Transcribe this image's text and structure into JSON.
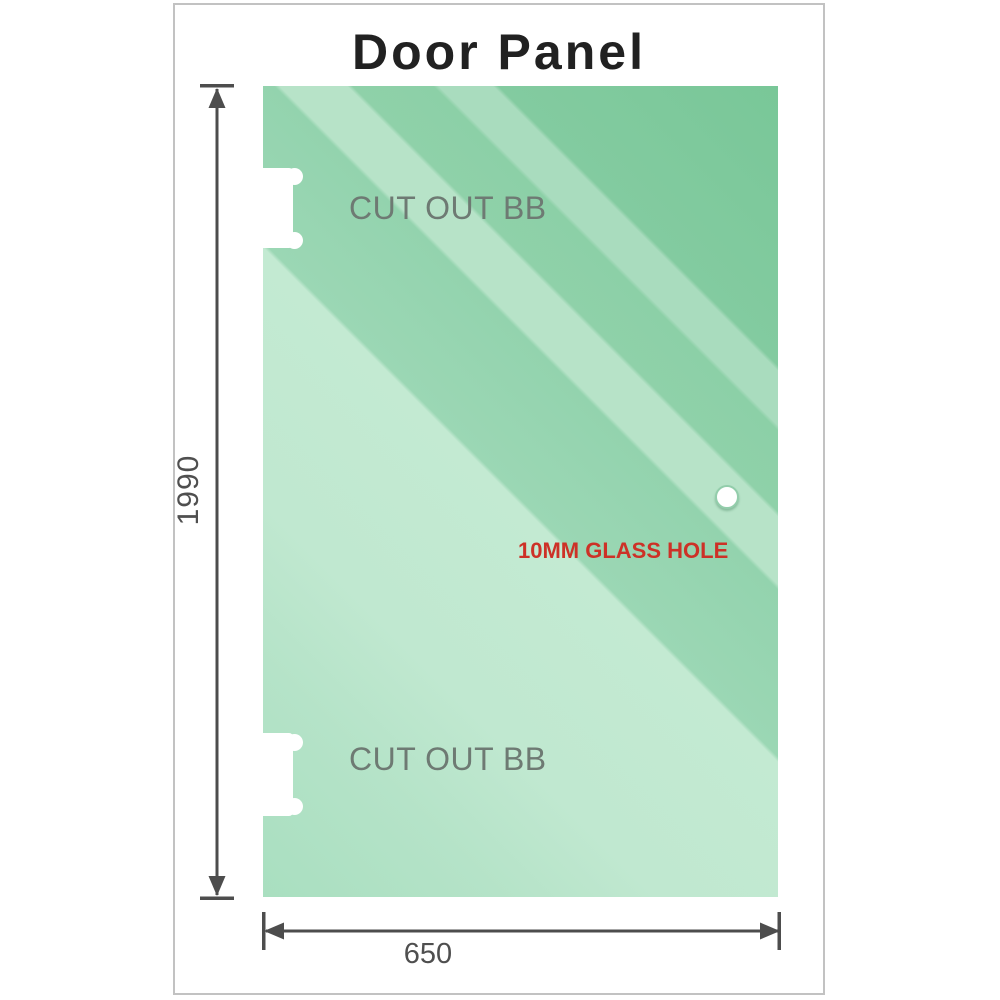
{
  "title": "Door Panel",
  "glass_panel": {
    "cutouts": [
      {
        "position": "top",
        "label": "CUT OUT BB"
      },
      {
        "position": "bottom",
        "label": "CUT OUT BB"
      }
    ],
    "hole_label": "10MM GLASS HOLE"
  },
  "dimensions": {
    "height_value": "1990",
    "width_value": "650"
  },
  "colors": {
    "glass_green_dark": "#79c798",
    "glass_green_light": "#c3ead2",
    "annotation_red": "#cd3127",
    "dimension_gray": "#4f4f4f",
    "cutout_label_gray": "#6e7a73",
    "title_text": "#212121",
    "frame_border": "#c2c2c2"
  }
}
